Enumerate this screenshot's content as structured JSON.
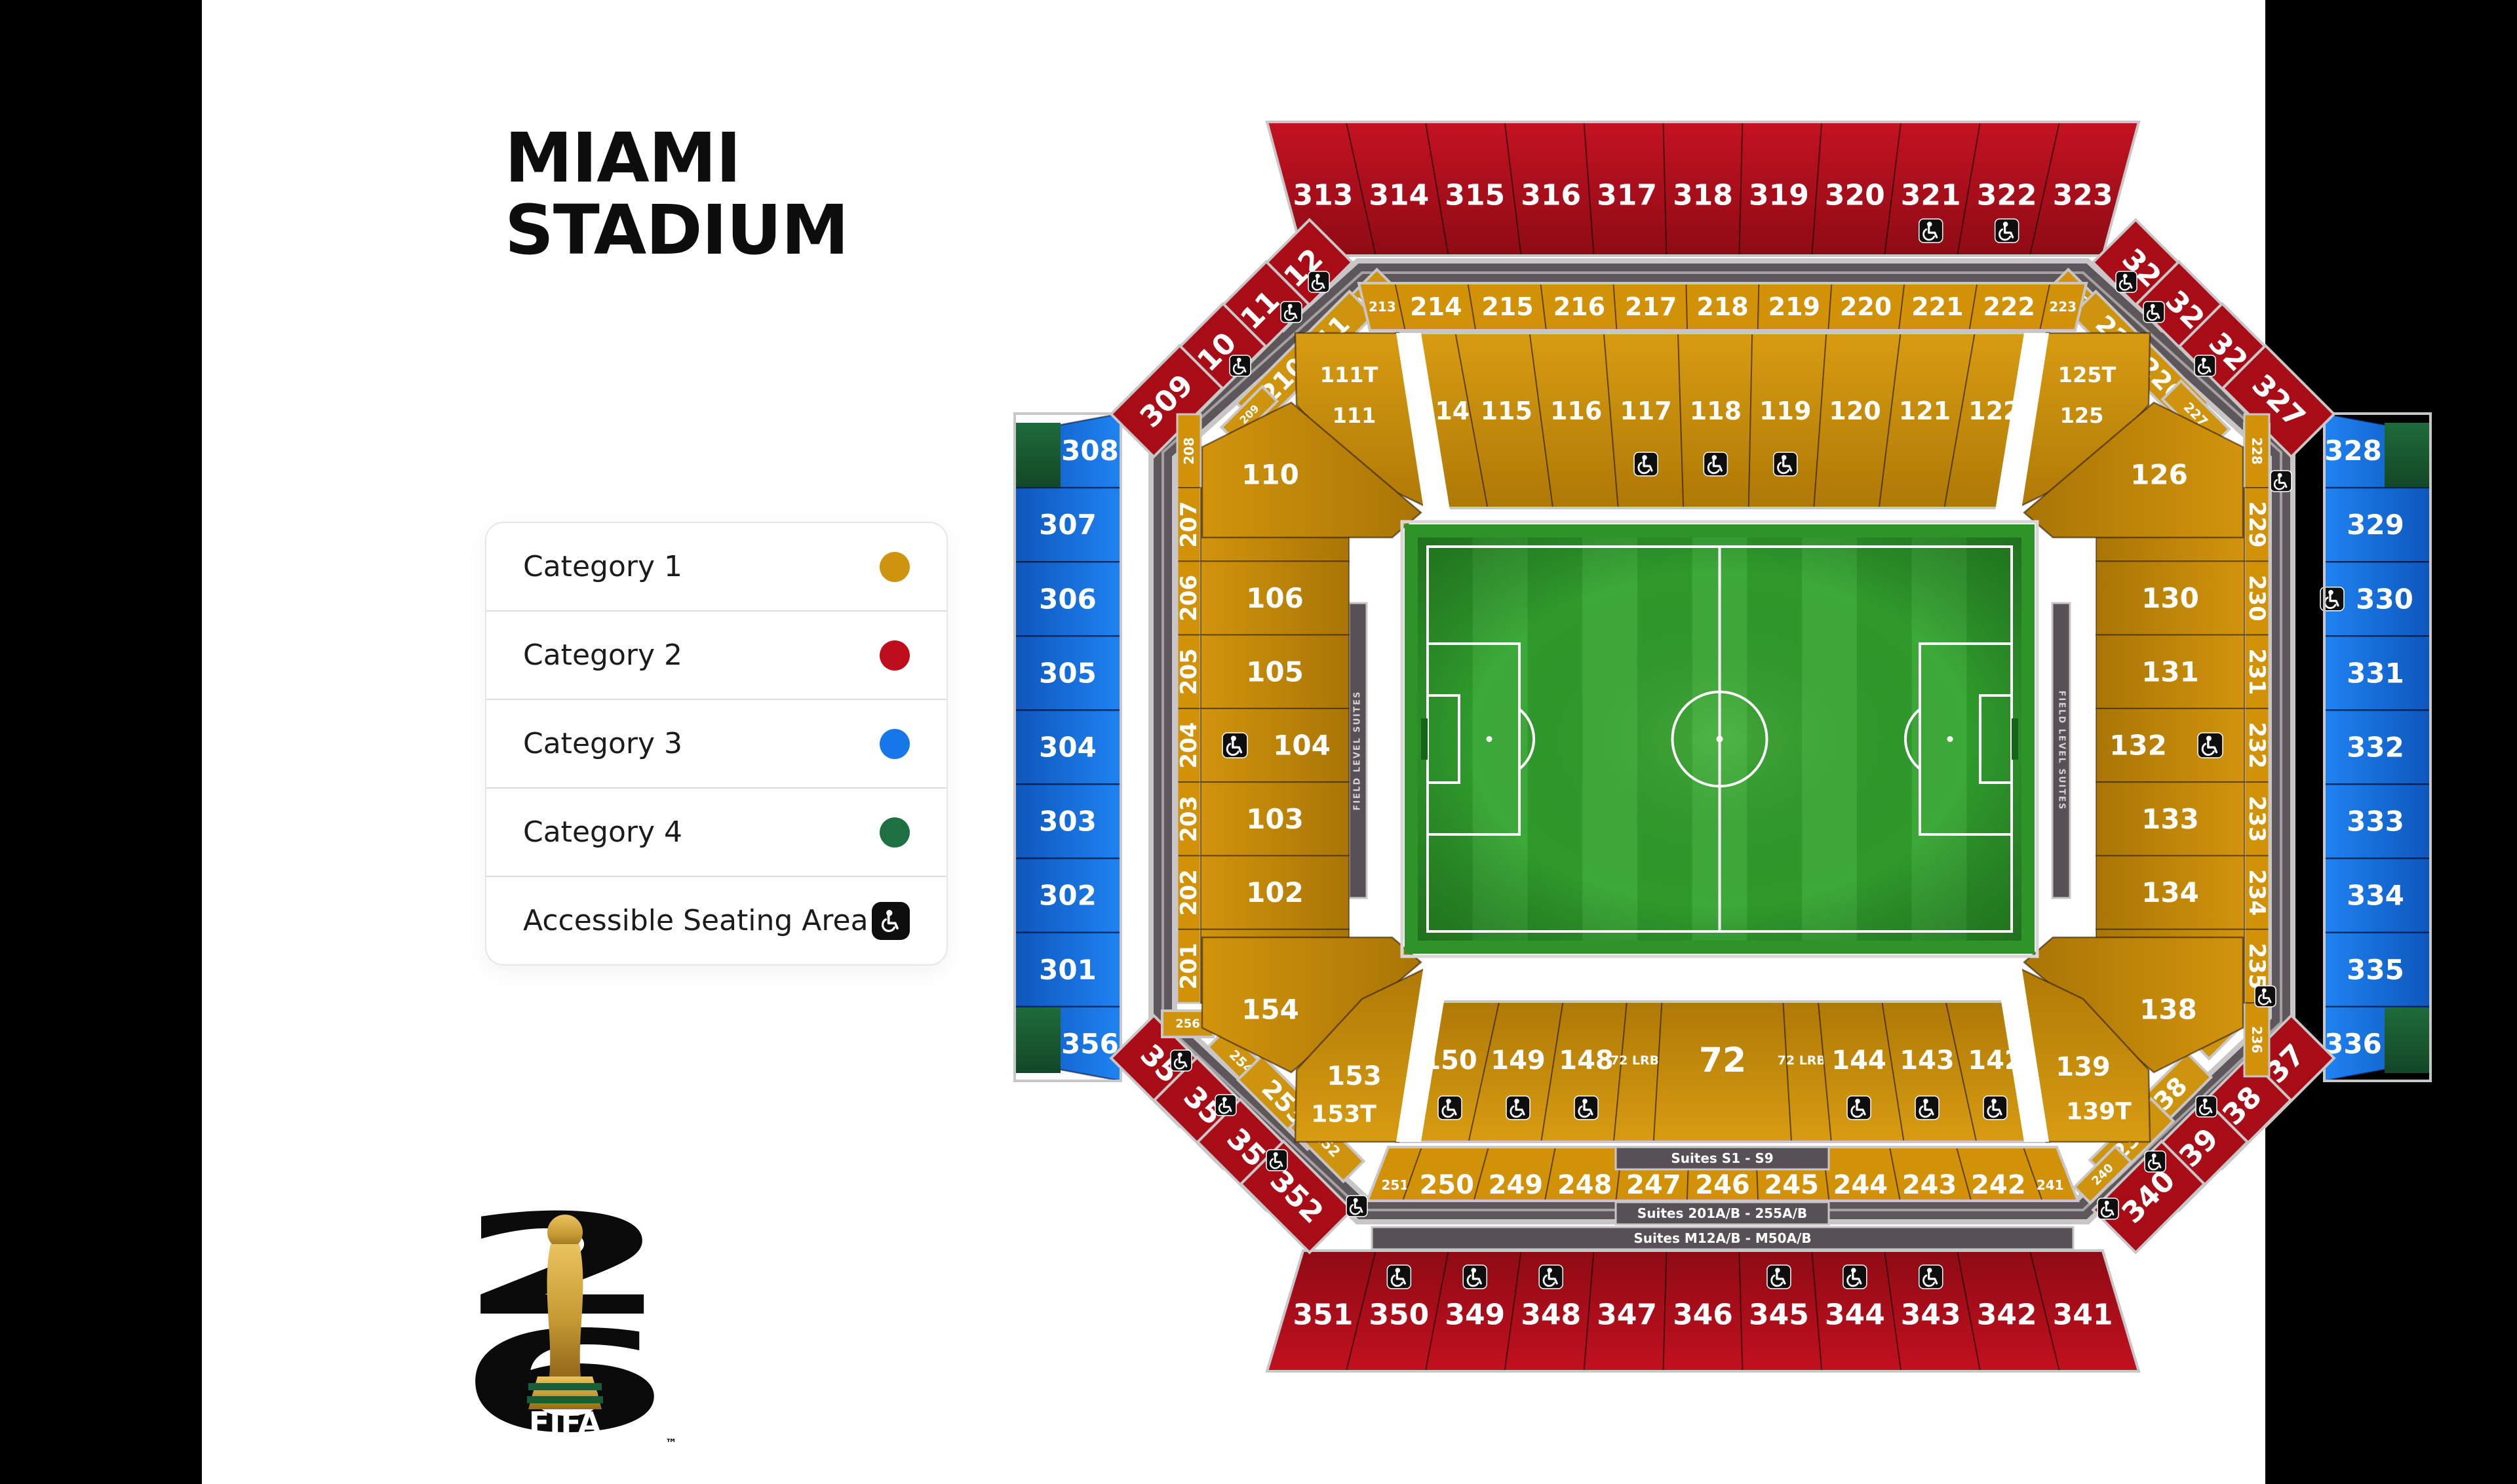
{
  "page": {
    "title_line1": "MIAMI",
    "title_line2": "STADIUM"
  },
  "legend": {
    "items": [
      {
        "label": "Category 1",
        "type": "dot",
        "color_key": "cat1"
      },
      {
        "label": "Category 2",
        "type": "dot",
        "color_key": "cat2"
      },
      {
        "label": "Category 3",
        "type": "dot",
        "color_key": "cat3"
      },
      {
        "label": "Category 4",
        "type": "dot",
        "color_key": "cat4"
      },
      {
        "label": "Accessible Seating Area",
        "type": "accessible"
      }
    ]
  },
  "colors": {
    "cat1": "#CE940E",
    "cat2": "#BE0E1E",
    "cat3": "#1877E8",
    "cat4": "#1E7042",
    "walkway": "#5D565A",
    "walkway_edge": "#C9C6C7",
    "suite_bar": "#575055",
    "accessible_bg": "#0E0E0E",
    "pitch_frame": "#2E9429",
    "pitch_stripe_a": "#2F9A2B",
    "pitch_stripe_b": "#3CA938"
  },
  "icons": {
    "accessible": "wheelchair-icon"
  },
  "suites": {
    "s1": "Suites S1 - S9",
    "s2": "Suites 201A/B - 255A/B",
    "s3": "Suites M12A/B - M50A/B",
    "side_label": "FIELD LEVEL SUITES"
  },
  "logo": {
    "digit_top": "2",
    "digit_bottom": "6",
    "wordmark": "FIFA",
    "tm": "™"
  },
  "sections": {
    "outer_top": [
      "313",
      "314",
      "315",
      "316",
      "317",
      "318",
      "319",
      "320",
      {
        "label": "321",
        "acc": true
      },
      {
        "label": "322",
        "acc": true
      },
      "323"
    ],
    "outer_bottom": [
      "351",
      {
        "label": "350",
        "acc": true
      },
      {
        "label": "349",
        "acc": true
      },
      {
        "label": "348",
        "acc": true
      },
      "347",
      "346",
      {
        "label": "345",
        "acc": true
      },
      {
        "label": "344",
        "acc": true
      },
      {
        "label": "343",
        "acc": true
      },
      "342",
      "341"
    ],
    "outer_left": [
      {
        "label": "308",
        "green": true
      },
      "307",
      "306",
      "305",
      "304",
      "303",
      "302",
      "301",
      {
        "label": "356",
        "green": true
      }
    ],
    "outer_right": [
      {
        "label": "328",
        "green": true
      },
      "329",
      {
        "label": "330",
        "acc": true
      },
      "331",
      "332",
      "333",
      "334",
      "335",
      {
        "label": "336",
        "green": true
      }
    ],
    "corner_tl_red": [
      "312",
      "311",
      "310",
      "309"
    ],
    "corner_tr_red": [
      "324",
      "325",
      "326",
      "327"
    ],
    "corner_bl_red": [
      "355",
      "354",
      "353",
      "352"
    ],
    "corner_br_red": [
      "337",
      "338",
      "339",
      "340"
    ],
    "corner_tl_gold": [
      "212",
      "211",
      "210",
      "209"
    ],
    "corner_tr_gold": [
      "224",
      "225",
      "226",
      "227",
      "228"
    ],
    "corner_bl_gold": [
      "256",
      "254",
      "253",
      "252"
    ],
    "corner_br_gold": [
      "237",
      "238",
      "239",
      "240"
    ],
    "band_top_200": [
      {
        "label": "213",
        "small": true
      },
      "214",
      "215",
      "216",
      "217",
      "218",
      "219",
      "220",
      "221",
      "222",
      {
        "label": "223",
        "small": true
      }
    ],
    "band_bottom_200": [
      {
        "label": "251",
        "small": true
      },
      "250",
      "249",
      "248",
      "247",
      "246",
      "245",
      "244",
      "243",
      "242",
      {
        "label": "241",
        "small": true
      }
    ],
    "strip_left_200": [
      {
        "label": "208",
        "small": true
      },
      "207",
      "206",
      "205",
      "204",
      "203",
      "202",
      "201"
    ],
    "strip_right_200": [
      {
        "label": "228",
        "small": true
      },
      "229",
      "230",
      "231",
      "232",
      "233",
      "234",
      "235",
      {
        "label": "236",
        "small": true
      }
    ],
    "inner_top": [
      {
        "label": "114",
        "w": 0.8
      },
      "115",
      "116",
      {
        "label": "117",
        "acc": true
      },
      {
        "label": "118",
        "acc": true
      },
      {
        "label": "119",
        "acc": true
      },
      "120",
      "121",
      "122"
    ],
    "inner_left": [
      {
        "label": "107",
        "acc": true
      },
      "106",
      "105",
      {
        "label": "104",
        "acc": true
      },
      "103",
      "102",
      {
        "label": "101",
        "acc": true
      }
    ],
    "inner_right": [
      {
        "label": "129",
        "acc": true
      },
      "130",
      "131",
      {
        "label": "132",
        "acc": true
      },
      "133",
      "134",
      {
        "label": "135",
        "acc": true
      }
    ],
    "inner_bottom": [
      {
        "label": "150",
        "acc": true
      },
      {
        "label": "149",
        "acc": true
      },
      {
        "label": "148",
        "acc": true
      },
      {
        "label": "72 LRB2",
        "small": true,
        "w": 0.55
      },
      {
        "label": "72",
        "w": 1.9,
        "big": true
      },
      {
        "label": "72 LRB1",
        "small": true,
        "w": 0.55
      },
      {
        "label": "144",
        "acc": true
      },
      {
        "label": "143",
        "acc": true
      },
      {
        "label": "142",
        "acc": true
      }
    ],
    "stack_tl": [
      "111T",
      "111",
      "110"
    ],
    "stack_tr": [
      "125T",
      "125",
      "126"
    ],
    "stack_bl": [
      "154",
      "153",
      "153T"
    ],
    "stack_br": [
      "138",
      "139",
      "139T"
    ]
  }
}
